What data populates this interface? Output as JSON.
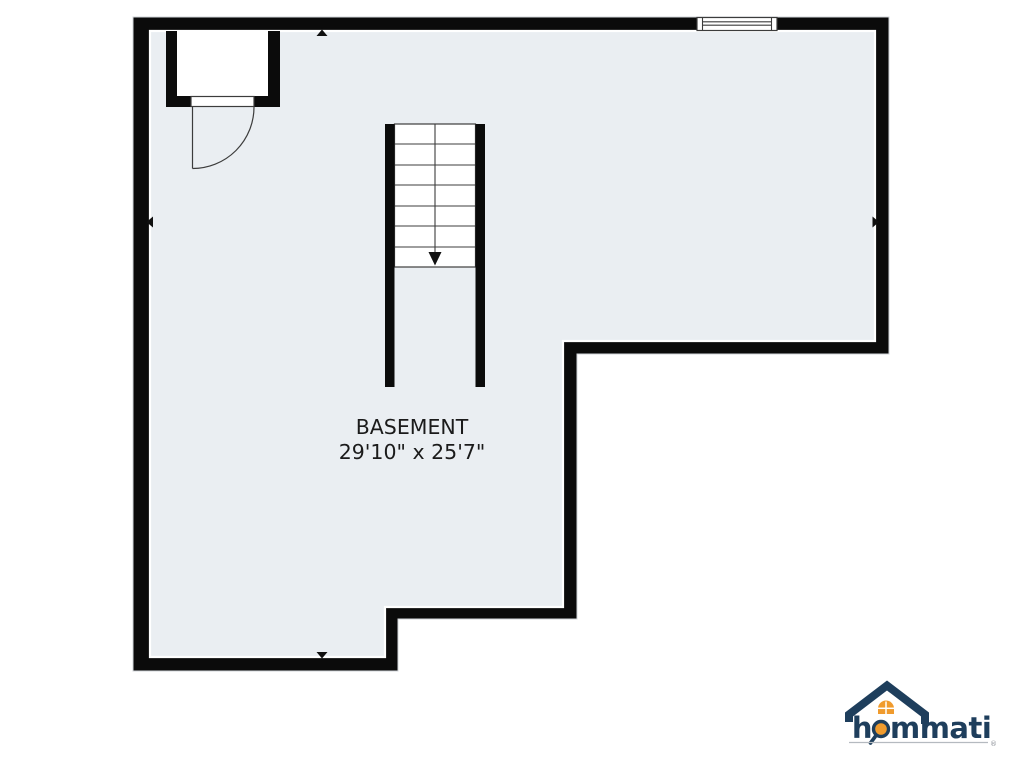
{
  "floorplan": {
    "room_label": "BASEMENT",
    "room_dimensions": "29'10\" x 25'7\"",
    "stairs": {
      "direction": "down",
      "visible_steps": 7
    },
    "features": [
      "closet-top-left",
      "hinged-door",
      "window-top-right",
      "staircase-down",
      "wall-direction-markers"
    ]
  },
  "colors": {
    "wall": "#0b0b0b",
    "floor": "#eaeef2",
    "outside": "#ffffff",
    "outer_edge": "#d2d5d8",
    "symbol_line": "#3c3c3c",
    "marker": "#101010",
    "text": "#1b1b1b",
    "logo_navy": "#1e3e5c",
    "logo_orange": "#f09b2d",
    "logo_underline": "#b5bac0"
  },
  "logo": {
    "brand": "hommati",
    "brand_display": {
      "pre": "h",
      "post": "mmati"
    },
    "registered_mark": "®"
  }
}
